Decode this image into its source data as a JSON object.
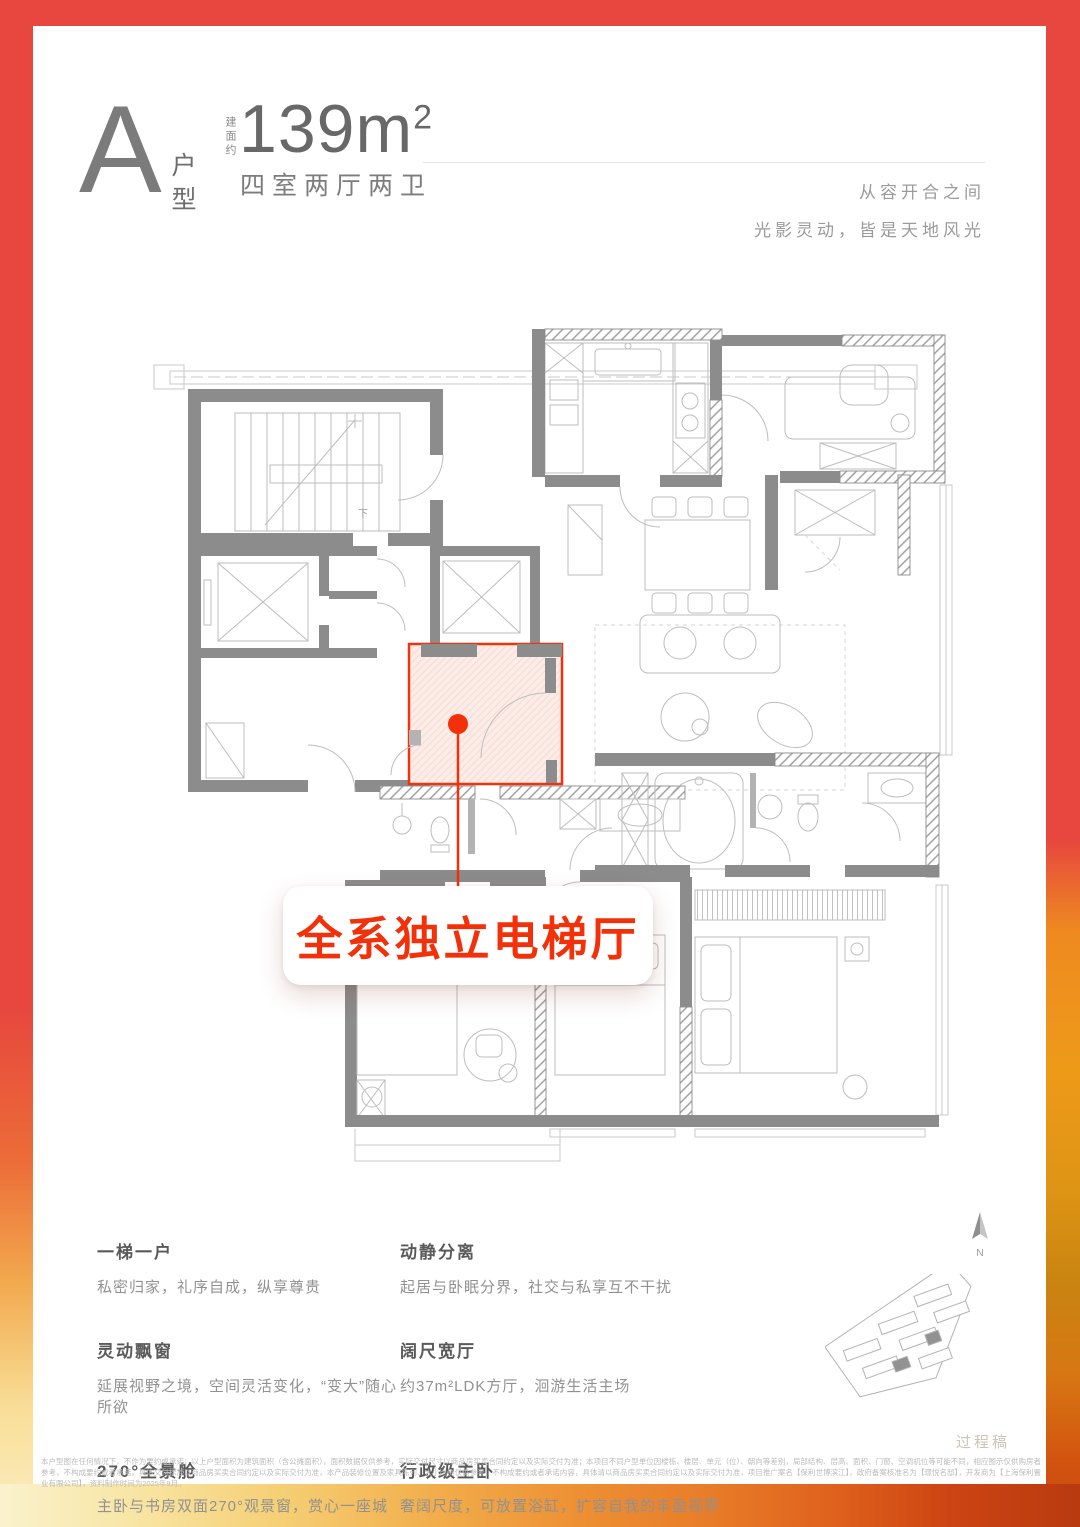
{
  "header": {
    "unit_letter": "A",
    "unit_type_label": "户型",
    "area_prefix": "建面约",
    "area_value": "139",
    "area_unit": "m",
    "area_exponent": "2",
    "room_config": "四室两厅两卫",
    "tagline_line1": "从容开合之间",
    "tagline_line2": "光影灵动，皆是天地风光"
  },
  "plan": {
    "callout_label": "全系独立电梯厅",
    "stair_down_label": "下"
  },
  "features": [
    {
      "title": "一梯一户",
      "desc": "私密归家，礼序自成，纵享尊贵"
    },
    {
      "title": "动静分离",
      "desc": "起居与卧眠分界，社交与私享互不干扰"
    },
    {
      "title": "灵动飘窗",
      "desc": "延展视野之境，空间灵活变化，“变大”随心所欲"
    },
    {
      "title": "阔尺宽厅",
      "desc": "约37m²LDK方厅，洄游生活主场"
    },
    {
      "title": "270°全景舱",
      "desc": "主卧与书房双面270°观景窗，赏心一座城"
    },
    {
      "title": "行政级主卧",
      "desc": "奢阔尺度，可放置浴缸，扩容自我的丰盈视界"
    }
  ],
  "footer": {
    "compass_label": "N",
    "watermark": "过程稿",
    "disclaimer_line1": "本户型图在任何情况下，不作为要约或承诺；以上户型面积为建筑面积（含公摊面积），面积数据仅供参考，实际交付尺寸以商品房买卖合同约定以及实际交付为准；本项目不同户型单位因楼栋、楼层、单元（位）、朝向等差别，局部结构、层高、面积、门窗、空调机位等可能不同，相应图示仅供购房者参考，不构成要约或者承",
    "disclaimer_line2": "诺，具体交付标准以商品房买卖合同约定以及实际交付为准，本产品装修位置及家具陈列、大小比例仅供参考，不构成要约或者承诺内容，具体请以商品房买卖合同约定以及实际交付为准，项目推广案名【保利世博滨江】，政府备案核准名为【璟悦名邸】，开发商为【上海保利置业有限公司】，资料制作时间为2025年9月。"
  },
  "colors": {
    "frame_red": "#E7473E",
    "accent_red": "#F23009",
    "highlight_fill": "#FBECE8",
    "wall_gray": "#8C8C8C",
    "furniture_gray": "#BDBDBD",
    "text_dark": "#5A5A5A",
    "text_light": "#919191"
  }
}
